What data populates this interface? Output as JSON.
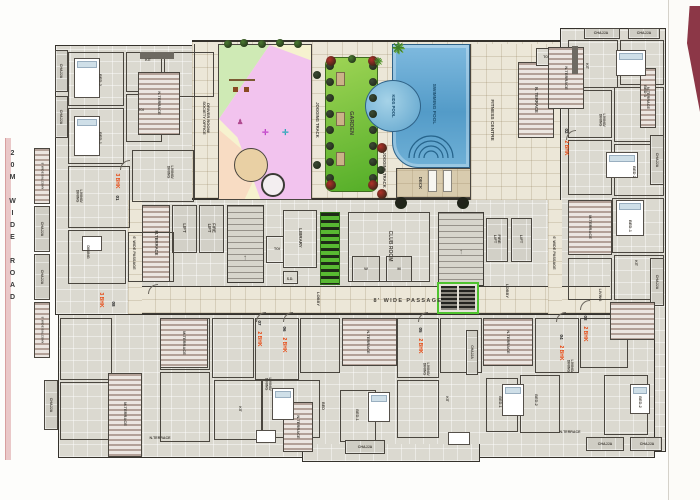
{
  "page": {
    "road_label": "20M WIDE ROAD"
  },
  "colors": {
    "wall": "#35322c",
    "floor": "#dbd9d0",
    "tile": "#ece7d8",
    "terrace_stripe": "#b3a198",
    "garden_green": "#54ae28",
    "pool_blue": "#5a9fcc",
    "play_pink": "#f2c3ee",
    "play_green": "#cfeab5",
    "play_peach": "#f8dcc3",
    "play_cream": "#f6f2cf",
    "unit_tag_red": "#e8440c",
    "lift_core_green": "#4fc32f",
    "ribbon_maroon": "#8c3747",
    "road_edge_pink": "#eac8c8"
  },
  "labels": [
    {
      "t": "GARDEN",
      "x": 351,
      "y": 123,
      "r": 90,
      "s": 5.5,
      "n": "label-garden"
    },
    {
      "t": "JOGGING TRACK",
      "x": 317,
      "y": 120,
      "r": 90,
      "s": 4.2,
      "n": "label-jogging-track"
    },
    {
      "t": "JOGGING TRACK",
      "x": 384,
      "y": 170,
      "r": 90,
      "s": 4.2,
      "n": "label-jogging-track"
    },
    {
      "t": "SWIMMING POOL",
      "x": 434,
      "y": 104,
      "r": 90,
      "s": 4.8,
      "c": "pool",
      "n": "label-swimming-pool"
    },
    {
      "t": "KIDS POOL",
      "x": 393,
      "y": 106,
      "r": 90,
      "s": 4.2,
      "c": "pool",
      "n": "label-kids-pool"
    },
    {
      "t": "DECK",
      "x": 420,
      "y": 183,
      "r": 90,
      "s": 4.4,
      "n": "label-deck"
    },
    {
      "t": "FITNESS CENTRE",
      "x": 492,
      "y": 120,
      "r": 90,
      "s": 4.8,
      "n": "label-fitness-centre"
    },
    {
      "t": "N. TERRACE",
      "x": 536,
      "y": 100,
      "r": 90,
      "s": 4.2,
      "n": "label-n-terrace"
    },
    {
      "t": "TOI",
      "x": 546,
      "y": 57,
      "r": 0,
      "s": 3.4,
      "n": "label-toi"
    },
    {
      "t": "DRIVER ROOM/\nSOCIETY OFFICE",
      "x": 206,
      "y": 118,
      "r": 90,
      "s": 4,
      "n": "label-driver-room-society-office"
    },
    {
      "t": "LIFT",
      "x": 184,
      "y": 228,
      "r": 90,
      "s": 4.4,
      "n": "label-lift"
    },
    {
      "t": "FIRE\nLIFT",
      "x": 211,
      "y": 228,
      "r": 90,
      "s": 4.2,
      "n": "label-fire-lift"
    },
    {
      "t": "M.TERRACE",
      "x": 156,
      "y": 243,
      "r": 90,
      "s": 4.2,
      "n": "label-m-terrace"
    },
    {
      "t": "TOI",
      "x": 277,
      "y": 249,
      "r": 0,
      "s": 3.6,
      "n": "label-toi"
    },
    {
      "t": "LIBRARY",
      "x": 300,
      "y": 238,
      "r": 90,
      "s": 4.4,
      "n": "label-library"
    },
    {
      "t": "S.D.",
      "x": 290,
      "y": 279,
      "r": 0,
      "s": 3.4,
      "n": "label-sd"
    },
    {
      "t": "CLUB ROOM",
      "x": 390,
      "y": 246,
      "r": 90,
      "s": 5,
      "n": "label-club-room"
    },
    {
      "t": "W",
      "x": 366,
      "y": 269,
      "r": 0,
      "s": 4,
      "n": "label-toilet-w"
    },
    {
      "t": "M",
      "x": 399,
      "y": 269,
      "r": 0,
      "s": 4,
      "n": "label-toilet-m"
    },
    {
      "t": "FIRE\nLIFT",
      "x": 497,
      "y": 239,
      "r": 90,
      "s": 4,
      "n": "label-fire-lift"
    },
    {
      "t": "LIFT",
      "x": 521,
      "y": 239,
      "r": 90,
      "s": 4,
      "n": "label-lift"
    },
    {
      "t": "LOBBY",
      "x": 318,
      "y": 299,
      "r": 90,
      "s": 4,
      "n": "label-lobby"
    },
    {
      "t": "LOBBY",
      "x": 507,
      "y": 291,
      "r": 90,
      "s": 4,
      "n": "label-lobby"
    },
    {
      "t": "8' WIDE PASSAGE",
      "x": 408,
      "y": 301,
      "r": 0,
      "s": 5.5,
      "ls": 2,
      "n": "label-8ft-wide-passage"
    },
    {
      "t": "6' WIDE PASSAGE",
      "x": 134,
      "y": 253,
      "r": 90,
      "s": 3.8,
      "n": "label-6ft-wide-passage"
    },
    {
      "t": "6' WIDE PASSAGE",
      "x": 554,
      "y": 253,
      "r": 90,
      "s": 3.8,
      "n": "label-6ft-wide-passage"
    },
    {
      "t": "↑",
      "x": 245,
      "y": 258,
      "r": 0,
      "s": 8,
      "c": "dim",
      "n": "stairs-up-arrow"
    },
    {
      "t": "↑",
      "x": 461,
      "y": 252,
      "r": 0,
      "s": 8,
      "c": "dim",
      "n": "stairs-up-arrow"
    },
    {
      "t": "3 BHK",
      "x": 117,
      "y": 181,
      "r": 90,
      "s": 5,
      "c": "red",
      "n": "unit-tag-3bhk"
    },
    {
      "t": "01",
      "x": 117,
      "y": 198,
      "r": 90,
      "s": 4.5,
      "c": "num",
      "n": "unit-number-01"
    },
    {
      "t": "3 BHK",
      "x": 101,
      "y": 300,
      "r": 90,
      "s": 5,
      "c": "red",
      "n": "unit-tag-3bhk"
    },
    {
      "t": "08",
      "x": 113,
      "y": 304,
      "r": 90,
      "s": 4.5,
      "c": "num",
      "n": "unit-number-08"
    },
    {
      "t": "2 BHK",
      "x": 566,
      "y": 148,
      "r": 90,
      "s": 5,
      "c": "red",
      "n": "unit-tag-2bhk"
    },
    {
      "t": "02",
      "x": 566,
      "y": 131,
      "r": 90,
      "s": 4.5,
      "c": "num",
      "n": "unit-number-02"
    },
    {
      "t": "2 BHK",
      "x": 259,
      "y": 339,
      "r": 90,
      "s": 5,
      "c": "red",
      "n": "unit-tag-2bhk"
    },
    {
      "t": "07",
      "x": 259,
      "y": 323,
      "r": 90,
      "s": 4.5,
      "c": "num",
      "n": "unit-number-07"
    },
    {
      "t": "2 BHK",
      "x": 284,
      "y": 345,
      "r": 90,
      "s": 5,
      "c": "red",
      "n": "unit-tag-2bhk"
    },
    {
      "t": "06",
      "x": 284,
      "y": 329,
      "r": 90,
      "s": 4.5,
      "c": "num",
      "n": "unit-number-06"
    },
    {
      "t": "2 BHK",
      "x": 420,
      "y": 346,
      "r": 90,
      "s": 5,
      "c": "red",
      "n": "unit-tag-2bhk"
    },
    {
      "t": "05",
      "x": 420,
      "y": 330,
      "r": 90,
      "s": 4.5,
      "c": "num",
      "n": "unit-number-05"
    },
    {
      "t": "2 BHK",
      "x": 561,
      "y": 353,
      "r": 90,
      "s": 5,
      "c": "red",
      "n": "unit-tag-2bhk"
    },
    {
      "t": "04",
      "x": 561,
      "y": 337,
      "r": 90,
      "s": 4.5,
      "c": "num",
      "n": "unit-number-04"
    },
    {
      "t": "2 BHK",
      "x": 585,
      "y": 334,
      "r": 90,
      "s": 5,
      "c": "red",
      "n": "unit-tag-2bhk"
    },
    {
      "t": "03",
      "x": 585,
      "y": 318,
      "r": 90,
      "s": 4.5,
      "c": "num",
      "n": "unit-number-03"
    },
    {
      "t": "N.TERRACE",
      "x": 159,
      "y": 103,
      "r": 90,
      "s": 4,
      "n": "label-n-terrace"
    },
    {
      "t": "CHAJJA",
      "x": 61,
      "y": 71,
      "r": 90,
      "s": 3.6,
      "n": "label-chajja"
    },
    {
      "t": "CHAJJA",
      "x": 61,
      "y": 117,
      "r": 90,
      "s": 3.6,
      "n": "label-chajja"
    },
    {
      "t": "5' WIDE BALCONY",
      "x": 42,
      "y": 176,
      "r": 90,
      "s": 3,
      "n": "label-balcony"
    },
    {
      "t": "CHAJJA",
      "x": 42,
      "y": 229,
      "r": 90,
      "s": 3.6,
      "n": "label-chajja"
    },
    {
      "t": "CHAJJA",
      "x": 42,
      "y": 277,
      "r": 90,
      "s": 3.6,
      "n": "label-chajja"
    },
    {
      "t": "5' WIDE BALCONY",
      "x": 42,
      "y": 330,
      "r": 90,
      "s": 3,
      "n": "label-balcony"
    },
    {
      "t": "CHAJJA",
      "x": 51,
      "y": 405,
      "r": 90,
      "s": 3.6,
      "n": "label-chajja"
    },
    {
      "t": "CHAJJA",
      "x": 601,
      "y": 33,
      "r": 0,
      "s": 3.6,
      "n": "label-chajja"
    },
    {
      "t": "CHAJJA",
      "x": 644,
      "y": 33,
      "r": 0,
      "s": 3.6,
      "n": "label-chajja"
    },
    {
      "t": "N.TERRACE",
      "x": 566,
      "y": 78,
      "r": 90,
      "s": 4,
      "n": "label-n-terrace"
    },
    {
      "t": "N.TERRACE",
      "x": 648,
      "y": 98,
      "r": 90,
      "s": 3.8,
      "n": "label-n-terrace"
    },
    {
      "t": "M.TERRACE",
      "x": 590,
      "y": 227,
      "r": 90,
      "s": 4,
      "n": "label-m-terrace"
    },
    {
      "t": "CHAJJA",
      "x": 657,
      "y": 160,
      "r": 90,
      "s": 3.6,
      "n": "label-chajja"
    },
    {
      "t": "CHAJJA",
      "x": 657,
      "y": 282,
      "r": 90,
      "s": 3.6,
      "n": "label-chajja"
    },
    {
      "t": "BED-2",
      "x": 100,
      "y": 80,
      "r": 90,
      "s": 4,
      "n": "label-bed2"
    },
    {
      "t": "BED-1",
      "x": 100,
      "y": 138,
      "r": 90,
      "s": 4,
      "n": "label-bed1"
    },
    {
      "t": "LIVING/\nDINING",
      "x": 79,
      "y": 196,
      "r": 90,
      "s": 3.6,
      "n": "label-living-dining"
    },
    {
      "t": "KIT",
      "x": 148,
      "y": 60,
      "r": 0,
      "s": 3.6,
      "n": "label-kitchen"
    },
    {
      "t": "TOI",
      "x": 141,
      "y": 110,
      "r": 0,
      "s": 3.4,
      "n": "label-toi"
    },
    {
      "t": "LIVING/\nDINING",
      "x": 170,
      "y": 172,
      "r": 90,
      "s": 3.6,
      "n": "label-living-dining"
    },
    {
      "t": "DINING",
      "x": 88,
      "y": 252,
      "r": 90,
      "s": 3.8,
      "n": "label-dining"
    },
    {
      "t": "KIT",
      "x": 587,
      "y": 66,
      "r": 90,
      "s": 3.6,
      "n": "label-kitchen"
    },
    {
      "t": "LIVING/\nDINING",
      "x": 602,
      "y": 120,
      "r": 90,
      "s": 3.6,
      "n": "label-living-dining"
    },
    {
      "t": "BED 3",
      "x": 645,
      "y": 91,
      "r": 90,
      "s": 4,
      "n": "label-bed3"
    },
    {
      "t": "BED 2",
      "x": 634,
      "y": 172,
      "r": 90,
      "s": 4,
      "n": "label-bed2"
    },
    {
      "t": "BED-1",
      "x": 630,
      "y": 226,
      "r": 90,
      "s": 4,
      "n": "label-bed1"
    },
    {
      "t": "KIT",
      "x": 636,
      "y": 263,
      "r": 90,
      "s": 3.6,
      "n": "label-kitchen"
    },
    {
      "t": "LIVING",
      "x": 600,
      "y": 295,
      "r": 90,
      "s": 3.8,
      "n": "label-living"
    },
    {
      "t": "N.TERRACE",
      "x": 368,
      "y": 342,
      "r": 90,
      "s": 4,
      "n": "label-n-terrace"
    },
    {
      "t": "N.TERRACE",
      "x": 508,
      "y": 342,
      "r": 90,
      "s": 4,
      "n": "label-n-terrace"
    },
    {
      "t": "M.TERRACE",
      "x": 125,
      "y": 414,
      "r": 90,
      "s": 4,
      "n": "label-m-terrace"
    },
    {
      "t": "M.TERRACE",
      "x": 184,
      "y": 343,
      "r": 90,
      "s": 4,
      "n": "label-m-terrace"
    },
    {
      "t": "N.TERRACE",
      "x": 298,
      "y": 427,
      "r": 90,
      "s": 4,
      "n": "label-n-terrace"
    },
    {
      "t": "N.TERRACE",
      "x": 160,
      "y": 438,
      "r": 0,
      "s": 3.6,
      "n": "label-n-terrace"
    },
    {
      "t": "N.TERRACE",
      "x": 570,
      "y": 432,
      "r": 0,
      "s": 3.6,
      "n": "label-n-terrace"
    },
    {
      "t": "CHAJJA",
      "x": 365,
      "y": 447,
      "r": 0,
      "s": 3.6,
      "n": "label-chajja"
    },
    {
      "t": "CHAJJA",
      "x": 472,
      "y": 352,
      "r": 90,
      "s": 3.4,
      "n": "label-chajja"
    },
    {
      "t": "CHAJJA",
      "x": 605,
      "y": 444,
      "r": 0,
      "s": 3.6,
      "n": "label-chajja"
    },
    {
      "t": "CHAJJA",
      "x": 647,
      "y": 444,
      "r": 0,
      "s": 3.6,
      "n": "label-chajja"
    },
    {
      "t": "LIVING/\nDINING",
      "x": 268,
      "y": 384,
      "r": 90,
      "s": 3.6,
      "n": "label-living-dining"
    },
    {
      "t": "LIVING/\nDINING",
      "x": 426,
      "y": 369,
      "r": 90,
      "s": 3.6,
      "n": "label-living-dining"
    },
    {
      "t": "LIVING/\nDINING",
      "x": 570,
      "y": 366,
      "r": 90,
      "s": 3.6,
      "n": "label-living-dining"
    },
    {
      "t": "BED-1",
      "x": 357,
      "y": 415,
      "r": 90,
      "s": 3.8,
      "n": "label-bed1"
    },
    {
      "t": "BED",
      "x": 323,
      "y": 406,
      "r": 90,
      "s": 3.8,
      "n": "label-bed"
    },
    {
      "t": "BED-1",
      "x": 500,
      "y": 402,
      "r": 90,
      "s": 3.8,
      "n": "label-bed1"
    },
    {
      "t": "BED-2",
      "x": 536,
      "y": 400,
      "r": 90,
      "s": 3.8,
      "n": "label-bed2"
    },
    {
      "t": "BED-2",
      "x": 640,
      "y": 402,
      "r": 90,
      "s": 3.8,
      "n": "label-bed2"
    },
    {
      "t": "KIT",
      "x": 240,
      "y": 409,
      "r": 90,
      "s": 3.4,
      "n": "label-kitchen"
    },
    {
      "t": "KIT",
      "x": 447,
      "y": 399,
      "r": 90,
      "s": 3.4,
      "n": "label-kitchen"
    }
  ],
  "decor": {
    "plants": [
      [
        330,
        66,
        4,
        "#3c4a34"
      ],
      [
        330,
        82,
        4,
        "#3c4a34"
      ],
      [
        330,
        98,
        4,
        "#3c4a34"
      ],
      [
        330,
        114,
        4,
        "#3c4a34"
      ],
      [
        330,
        130,
        4,
        "#3c4a34"
      ],
      [
        330,
        146,
        4,
        "#3c4a34"
      ],
      [
        330,
        162,
        4,
        "#3c4a34"
      ],
      [
        330,
        178,
        4,
        "#3c4a34"
      ],
      [
        373,
        66,
        4,
        "#3c4a34"
      ],
      [
        373,
        82,
        4,
        "#3c4a34"
      ],
      [
        373,
        98,
        4,
        "#3c4a34"
      ],
      [
        373,
        114,
        4,
        "#3c4a34"
      ],
      [
        373,
        130,
        4,
        "#3c4a34"
      ],
      [
        373,
        146,
        4,
        "#3c4a34"
      ],
      [
        373,
        162,
        4,
        "#3c4a34"
      ],
      [
        373,
        178,
        4,
        "#3c4a34"
      ],
      [
        331,
        61,
        5,
        "#b03028"
      ],
      [
        373,
        61,
        5,
        "#b03028"
      ],
      [
        331,
        185,
        5,
        "#b03028"
      ],
      [
        373,
        185,
        5,
        "#b03028"
      ],
      [
        352,
        59,
        4,
        "#4a7a30"
      ],
      [
        228,
        44,
        4,
        "#4a7a30"
      ],
      [
        244,
        43,
        4,
        "#4a7a30"
      ],
      [
        262,
        44,
        4,
        "#4a7a30"
      ],
      [
        280,
        43,
        4,
        "#4a7a30"
      ],
      [
        298,
        44,
        4,
        "#4a7a30"
      ],
      [
        317,
        75,
        4,
        "#3c4a34"
      ],
      [
        317,
        165,
        4,
        "#3c4a34"
      ],
      [
        382,
        148,
        5,
        "#b03028"
      ],
      [
        381,
        170,
        4,
        "#3c4a34"
      ],
      [
        382,
        194,
        5,
        "#b03028"
      ],
      [
        401,
        203,
        6,
        "#23231c"
      ],
      [
        463,
        203,
        6,
        "#23231c"
      ]
    ],
    "palms": [
      [
        398,
        48,
        15
      ],
      [
        378,
        62,
        10
      ]
    ],
    "benches": [
      [
        336,
        78
      ],
      [
        336,
        118
      ],
      [
        336,
        158
      ]
    ]
  }
}
